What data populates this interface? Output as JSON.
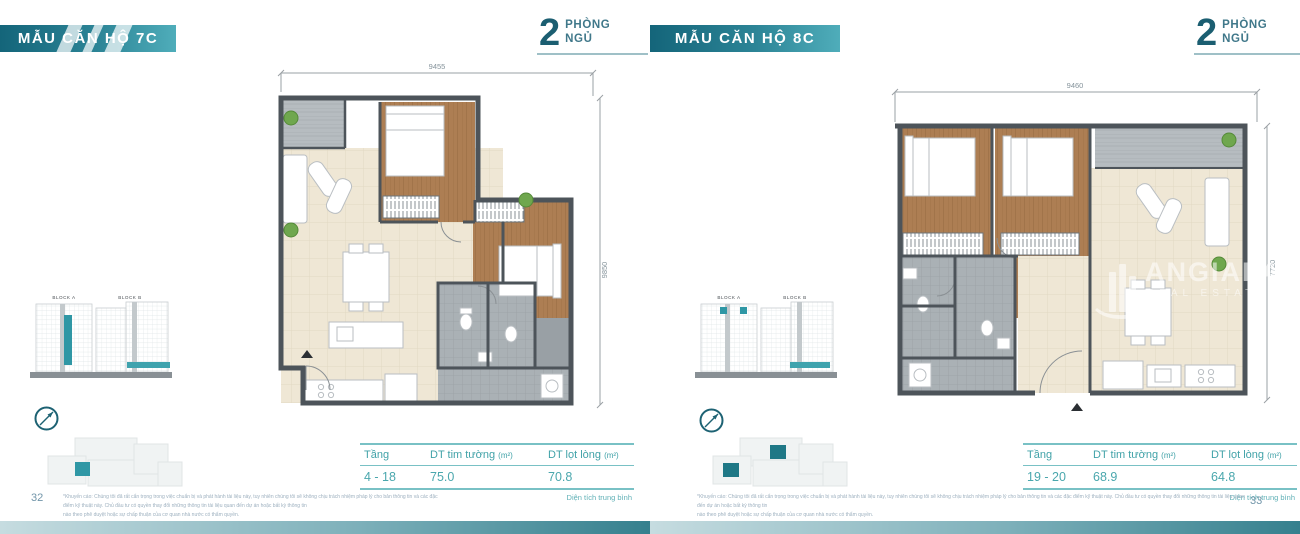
{
  "watermark": {
    "brand": "ANGIALAND",
    "brand_sub": "REAL ESTATE"
  },
  "disclaimer": {
    "line1": "*Khuyến cáo: Chúng tôi đã rất cẩn trọng trong việc chuẩn bị và phát hành tài liệu này, tuy nhiên chúng tôi sẽ không chịu trách nhiệm pháp lý cho bản thông tin và các đặc điểm kỹ thuật này. Chủ đầu tư có quyền thay đổi những thông tin tài liệu quan đến dự án hoặc bất kỳ thông tin",
    "line2": "nào theo phê duyệt hoặc sự chấp thuận của cơ quan nhà nước có thẩm quyền."
  },
  "pages": [
    {
      "banner_title": "MẪU CĂN HỘ 7C",
      "bedrooms": {
        "number": "2",
        "word_top": "PHÒNG",
        "word_bottom": "NGỦ"
      },
      "plan": {
        "dim_width": "9455",
        "dim_height": "9850"
      },
      "blocks": {
        "a_label": "BLOCK A",
        "b_label": "BLOCK B"
      },
      "table": {
        "col_floor": "Tầng",
        "col_wall_area": "DT tim tường",
        "col_net_area": "DT lọt lòng",
        "area_unit": "(m²)",
        "floor_range": "4 - 18",
        "wall_area": "75.0",
        "net_area": "70.8",
        "caption": "Diện tích trung bình"
      },
      "footer": {
        "page_number": "32"
      }
    },
    {
      "banner_title": "MẪU CĂN HỘ 8C",
      "bedrooms": {
        "number": "2",
        "word_top": "PHÒNG",
        "word_bottom": "NGỦ"
      },
      "plan": {
        "dim_width": "9460",
        "dim_height": "7720"
      },
      "blocks": {
        "a_label": "BLOCK A",
        "b_label": "BLOCK B"
      },
      "table": {
        "col_floor": "Tầng",
        "col_wall_area": "DT tim tường",
        "col_net_area": "DT lọt lòng",
        "area_unit": "(m²)",
        "floor_range": "19 - 20",
        "wall_area": "68.9",
        "net_area": "64.8",
        "caption": "Diện tích trung bình"
      },
      "footer": {
        "page_number": "33"
      }
    }
  ],
  "colors": {
    "banner_dark": "#14657a",
    "banner_light": "#4fadba",
    "accent_teal": "#2f97a5",
    "table_text": "#41a2a8",
    "wood_floor": "#ad7e53",
    "wall": "#4d545a"
  }
}
